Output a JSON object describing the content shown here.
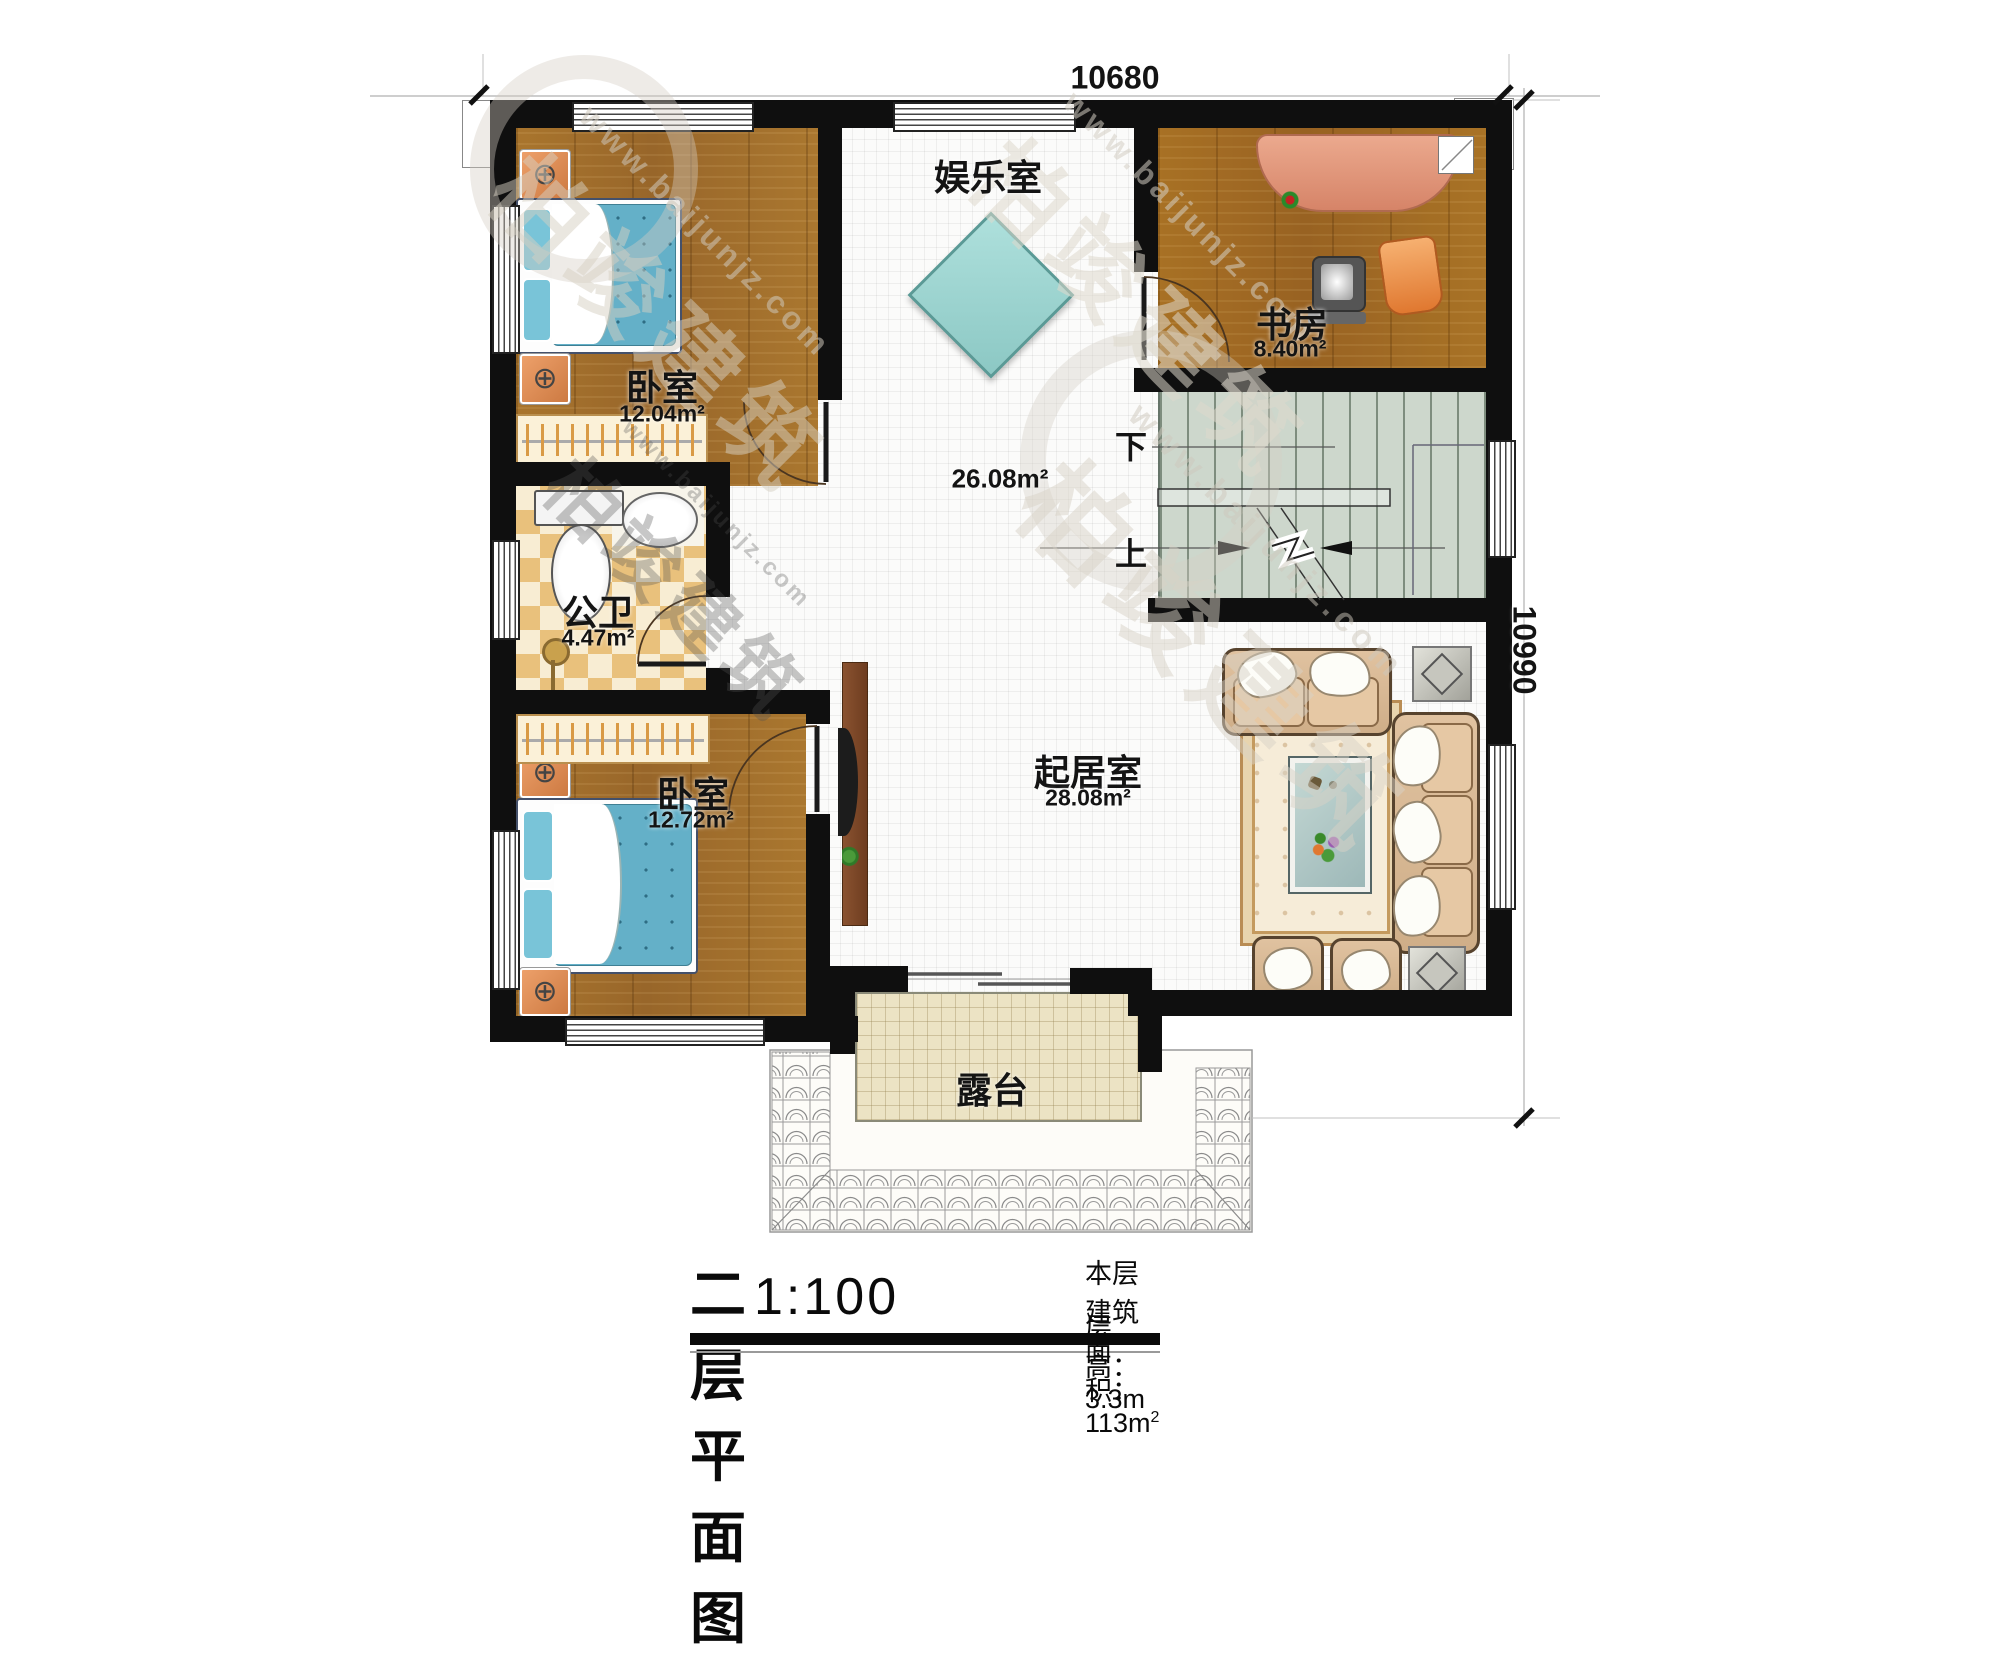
{
  "plan": {
    "title": "二层平面图",
    "scale": "1:100",
    "area_label": "本层建筑面积：113m",
    "area_sup": "2",
    "height_label": "层高：3.3m"
  },
  "dimensions": {
    "top": "10680",
    "right": "10990"
  },
  "rooms": [
    {
      "name": "卧室",
      "area": "12.04m²"
    },
    {
      "name": "公卫",
      "area": "4.47m²"
    },
    {
      "name": "卧室",
      "area": "12.72m²"
    },
    {
      "name": "娱乐室",
      "area": ""
    },
    {
      "name": "书房",
      "area": "8.40m²"
    },
    {
      "name": "起居室",
      "area": "28.08m²"
    },
    {
      "name": "",
      "area": "26.08m²"
    },
    {
      "name": "露台",
      "area": ""
    }
  ],
  "stairs": {
    "down": "下",
    "up": "上"
  },
  "watermark": {
    "brand": "柏竣建筑",
    "url": "www.baijunjz.com"
  },
  "colors": {
    "wall": "#0f0f0f",
    "wood_floor": "#a5722c",
    "white_tile": "#fbfbfa",
    "bath_checker": "#e9c17c",
    "stair_floor": "#cdd7cc",
    "terrace_floor": "#ece3c4",
    "bed_blue": "#64b0c8",
    "table_teal": "#9fd8d4",
    "sofa_beige": "#d9b896"
  }
}
